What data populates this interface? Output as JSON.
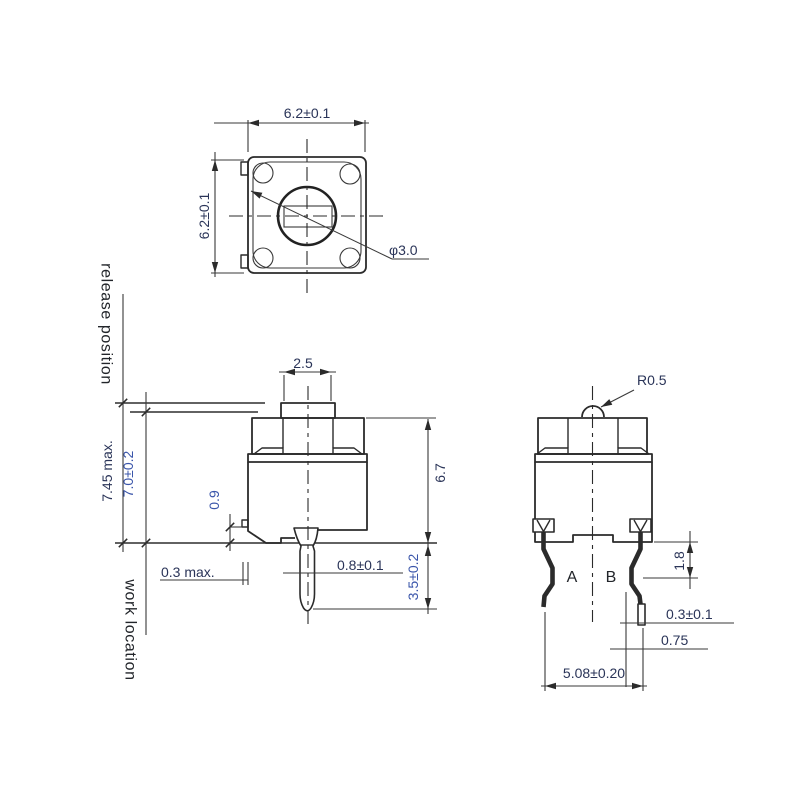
{
  "top_view": {
    "width_dim": "6.2±0.1",
    "height_dim": "6.2±0.1",
    "hole_diameter": "φ3.0"
  },
  "front_view": {
    "release_label": "release position",
    "work_label": "work location",
    "plunger_width": "2.5",
    "free_height": "7.45 max.",
    "operating_height": "7.0±0.2",
    "stub_height": "0.9",
    "stub_protrusion": "0.3 max.",
    "terminal_width": "0.8±0.1",
    "terminal_length": "3.5±0.2",
    "body_height": "6.7"
  },
  "side_view": {
    "dome_radius": "R0.5",
    "terminal_a_label": "A",
    "terminal_b_label": "B",
    "bend_offset": "1.8",
    "lead_thickness": "0.3±0.1",
    "lead_tip_offset": "0.75",
    "lead_spacing": "5.08±0.20"
  },
  "colors": {
    "line": "#2b2b2b",
    "dim_text": "#2a3458",
    "accent_text": "#3a55aa",
    "label_text": "#22252a",
    "background": "#ffffff"
  }
}
